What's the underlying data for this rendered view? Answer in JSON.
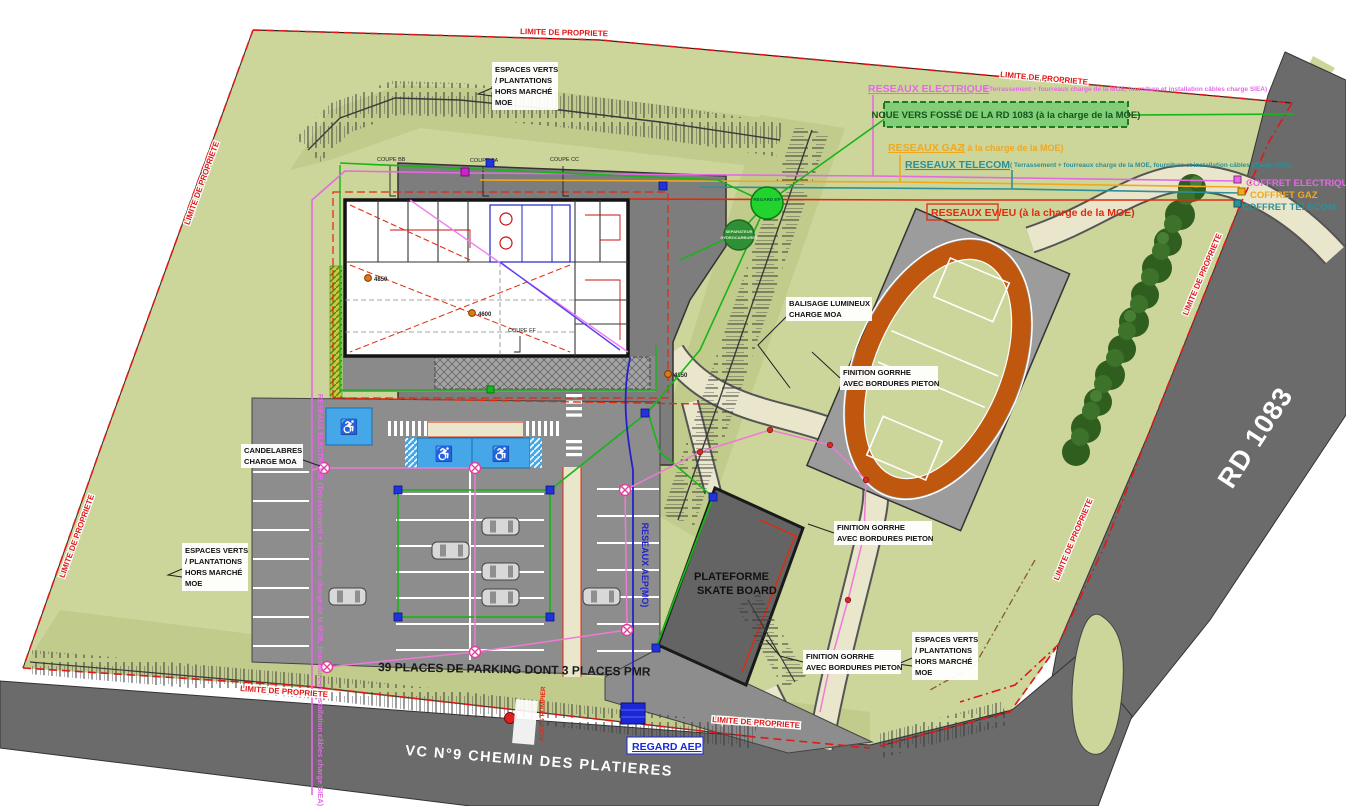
{
  "colors": {
    "site_green": "#ccd69b",
    "shade_green": "#c1cb8c",
    "road_gray": "#6b6b6b",
    "parking_gray": "#8d8d8d",
    "apron_gray": "#7d7d7d",
    "path_beige": "#eae6cb",
    "track_orange": "#c0570e",
    "pmr_blue": "#45a7e8",
    "limite_red": "#e01818",
    "electrique_magenta": "#e46ae4",
    "gaz_orange": "#f0a81e",
    "telecom_teal": "#2e8f96",
    "eveu_red": "#e02a10",
    "aep_blue": "#2222cc",
    "noue_green": "#1d7a1d",
    "tree_green": "#3a6b28"
  },
  "labels": {
    "limite": "LIMITE DE PROPRIETE",
    "rd_road": "RD 1083",
    "vc_road": "VC N°9 CHEMIN DES PLATIERES",
    "parking_count": "39 PLACES DE PARKING DONT 3 PLACES PMR",
    "skate_line1": "PLATEFORME",
    "skate_line2": "SKATE BOARD",
    "regard_aep": "REGARD AEP",
    "acces_pompier": "ACCES POMPIER"
  },
  "networks": {
    "electrique_title": "RESEAUX ELECTRIQUE",
    "electrique_note": "( Terrassement + fourreaux charge de la MOE, fourniture et installation câbles charge SIEA)",
    "noue": "NOUE VERS FOSSÉ DE LA RD 1083 (à la charge de la MOE)",
    "gaz_title": "RESEAUX GAZ",
    "gaz_note": "( à la charge de la MOE)",
    "telecom_title": "RESEAUX TELECOM",
    "telecom_note": "( Terrassement + fourreaux charge de la MOE, fourniture et installation câbles charge SIEA)",
    "eveu": "RESEAUX EV/EU (à la charge de la MOE)",
    "aep_vertical": "RESEAUX AEP(MO)",
    "electrique_vertical": "RESEAUX ELECTRIQUE (Terrassement + fourreaux charge de la MOE, fourniture et installation câbles charge SIEA)",
    "coffret_electrique": "COFFRET ELECTRIQUE",
    "coffret_gaz": "COFFRET GAZ",
    "coffret_telecom": "COFFRET TELECOM"
  },
  "annotations": {
    "espaces_verts": [
      "ESPACES VERTS",
      "/ PLANTATIONS",
      "HORS MARCHÉ",
      "MOE"
    ],
    "candelabres": [
      "CANDELABRES",
      "CHARGE MOA"
    ],
    "balisage": [
      "BALISAGE LUMINEUX",
      "CHARGE MOA"
    ],
    "finition": [
      "FINITION GORRHE",
      "AVEC BORDURES PIETON"
    ],
    "separateur": [
      "SEPARATEUR",
      "HYDROCARBURES"
    ],
    "regard_ep": "REGARD EP"
  },
  "building": {
    "coupe_bb": "COUPE BB",
    "coupe_aa": "COUPE AA",
    "coupe_cc": "COUPE CC",
    "coupe_ff": "COUPE FF",
    "levels": [
      "4850",
      "4600",
      "4850"
    ]
  },
  "icons": {
    "wheelchair": "♿"
  }
}
